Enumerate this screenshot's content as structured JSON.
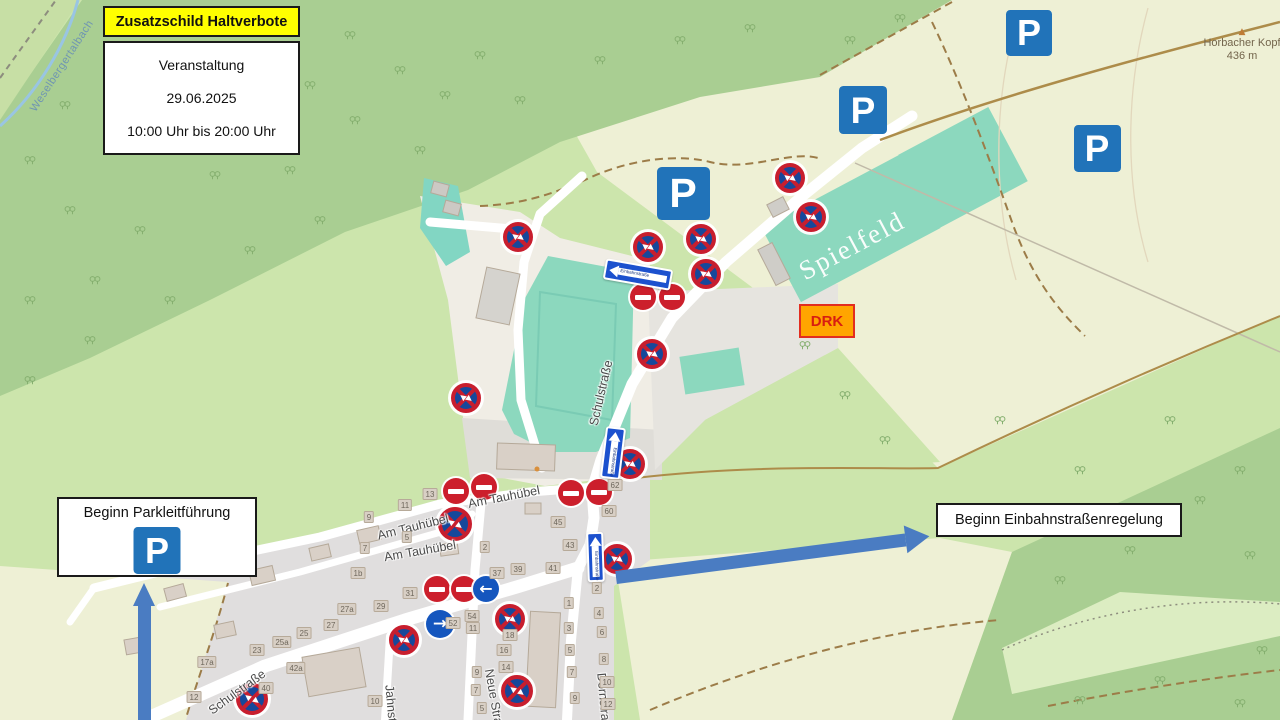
{
  "legend": {
    "title": "Zusatzschild Haltverbote",
    "lines": [
      "Veranstaltung",
      "29.06.2025",
      "10:00 Uhr bis 20:00 Uhr"
    ]
  },
  "callouts": {
    "parkleitfuehrung": "Beginn Parkleitführung",
    "einbahn": "Beginn Einbahnstraßenregelung",
    "drk": "DRK"
  },
  "labels": {
    "spielfeld": "Spielfeld",
    "peak_name": "Horbacher Kopf",
    "peak_elevation": "436 m",
    "peak_icon": "▲",
    "stream": "Weselbergertalbach",
    "streets": [
      {
        "text": "Schulstraße",
        "x": 601,
        "y": 393,
        "rot": -77
      },
      {
        "text": "Schulstraße",
        "x": 237,
        "y": 692,
        "rot": -36
      },
      {
        "text": "Am Tauhübel",
        "x": 504,
        "y": 497,
        "rot": -11
      },
      {
        "text": "Am Tauhübel",
        "x": 413,
        "y": 527,
        "rot": -14
      },
      {
        "text": "Am Tauhübel",
        "x": 420,
        "y": 551,
        "rot": -10
      },
      {
        "text": "Neue Straße",
        "x": 495,
        "y": 704,
        "rot": 80
      },
      {
        "text": "Dornstraße",
        "x": 604,
        "y": 704,
        "rot": 85
      },
      {
        "text": "Jahnstraße",
        "x": 392,
        "y": 716,
        "rot": 85
      }
    ],
    "house_numbers": [
      {
        "t": "13",
        "x": 430,
        "y": 494
      },
      {
        "t": "11",
        "x": 405,
        "y": 505
      },
      {
        "t": "9",
        "x": 369,
        "y": 517
      },
      {
        "t": "5",
        "x": 407,
        "y": 537
      },
      {
        "t": "7",
        "x": 365,
        "y": 548
      },
      {
        "t": "1b",
        "x": 358,
        "y": 573
      },
      {
        "t": "2",
        "x": 485,
        "y": 547
      },
      {
        "t": "45",
        "x": 558,
        "y": 522
      },
      {
        "t": "43",
        "x": 570,
        "y": 545
      },
      {
        "t": "41",
        "x": 553,
        "y": 568
      },
      {
        "t": "39",
        "x": 518,
        "y": 569
      },
      {
        "t": "37",
        "x": 497,
        "y": 573
      },
      {
        "t": "31",
        "x": 410,
        "y": 593
      },
      {
        "t": "29",
        "x": 381,
        "y": 606
      },
      {
        "t": "62",
        "x": 615,
        "y": 485
      },
      {
        "t": "60",
        "x": 609,
        "y": 511
      },
      {
        "t": "27a",
        "x": 347,
        "y": 609
      },
      {
        "t": "27",
        "x": 331,
        "y": 625
      },
      {
        "t": "25",
        "x": 304,
        "y": 633
      },
      {
        "t": "25a",
        "x": 282,
        "y": 642
      },
      {
        "t": "23",
        "x": 257,
        "y": 650
      },
      {
        "t": "42a",
        "x": 296,
        "y": 668
      },
      {
        "t": "17a",
        "x": 207,
        "y": 662
      },
      {
        "t": "12",
        "x": 194,
        "y": 697
      },
      {
        "t": "40",
        "x": 266,
        "y": 688
      },
      {
        "t": "10",
        "x": 375,
        "y": 701
      },
      {
        "t": "54",
        "x": 472,
        "y": 616
      },
      {
        "t": "52",
        "x": 453,
        "y": 623
      },
      {
        "t": "11",
        "x": 473,
        "y": 628
      },
      {
        "t": "18",
        "x": 510,
        "y": 635
      },
      {
        "t": "16",
        "x": 504,
        "y": 650
      },
      {
        "t": "14",
        "x": 506,
        "y": 667
      },
      {
        "t": "9",
        "x": 477,
        "y": 672
      },
      {
        "t": "7",
        "x": 476,
        "y": 690
      },
      {
        "t": "5",
        "x": 482,
        "y": 708
      },
      {
        "t": "1",
        "x": 569,
        "y": 603
      },
      {
        "t": "3",
        "x": 569,
        "y": 628
      },
      {
        "t": "5",
        "x": 570,
        "y": 650
      },
      {
        "t": "7",
        "x": 572,
        "y": 672
      },
      {
        "t": "9",
        "x": 575,
        "y": 698
      },
      {
        "t": "2",
        "x": 597,
        "y": 588
      },
      {
        "t": "4",
        "x": 599,
        "y": 613
      },
      {
        "t": "6",
        "x": 602,
        "y": 632
      },
      {
        "t": "8",
        "x": 604,
        "y": 659
      },
      {
        "t": "10",
        "x": 607,
        "y": 682
      },
      {
        "t": "12",
        "x": 608,
        "y": 704
      }
    ]
  },
  "signs": {
    "parking_letter": "P",
    "one_way_label": "Einbahnstraße",
    "arrow_left_glyph": "←",
    "arrow_right_glyph": "→",
    "parking": [
      {
        "x": 1029,
        "y": 33,
        "s": 46
      },
      {
        "x": 863,
        "y": 110,
        "s": 48
      },
      {
        "x": 1097,
        "y": 148,
        "s": 47
      },
      {
        "x": 683,
        "y": 193,
        "s": 53
      }
    ],
    "no_stopping": [
      {
        "x": 790,
        "y": 178,
        "s": 30
      },
      {
        "x": 811,
        "y": 217,
        "s": 30
      },
      {
        "x": 518,
        "y": 237,
        "s": 30
      },
      {
        "x": 648,
        "y": 247,
        "s": 30
      },
      {
        "x": 701,
        "y": 239,
        "s": 30
      },
      {
        "x": 706,
        "y": 274,
        "s": 30
      },
      {
        "x": 652,
        "y": 354,
        "s": 30
      },
      {
        "x": 466,
        "y": 398,
        "s": 30
      },
      {
        "x": 630,
        "y": 464,
        "s": 30
      },
      {
        "x": 617,
        "y": 559,
        "s": 30
      },
      {
        "x": 455,
        "y": 524,
        "s": 34
      },
      {
        "x": 404,
        "y": 640,
        "s": 30
      },
      {
        "x": 510,
        "y": 619,
        "s": 30
      },
      {
        "x": 517,
        "y": 691,
        "s": 32
      },
      {
        "x": 252,
        "y": 699,
        "s": 32
      }
    ],
    "no_entry": [
      {
        "x": 643,
        "y": 297
      },
      {
        "x": 672,
        "y": 297
      },
      {
        "x": 456,
        "y": 491
      },
      {
        "x": 484,
        "y": 487
      },
      {
        "x": 571,
        "y": 493
      },
      {
        "x": 599,
        "y": 492
      },
      {
        "x": 437,
        "y": 589
      },
      {
        "x": 464,
        "y": 589
      }
    ],
    "mandatory": [
      {
        "x": 486,
        "y": 589,
        "s": 26,
        "dir": "left"
      },
      {
        "x": 440,
        "y": 624,
        "s": 28,
        "dir": "right"
      }
    ],
    "one_way": [
      {
        "x": 638,
        "y": 274,
        "w": 68,
        "h": 21,
        "rot": 10,
        "dir": "left"
      },
      {
        "x": 613,
        "y": 453,
        "w": 20,
        "h": 52,
        "rot": 7,
        "dir": "up"
      },
      {
        "x": 595,
        "y": 557,
        "w": 17,
        "h": 50,
        "rot": -2,
        "dir": "up"
      }
    ]
  },
  "colors": {
    "parking_blue": "#2173B9",
    "oneway_blue": "#1C51CE",
    "sign_red": "#C81E2E",
    "sign_inner_blue": "#16489B",
    "annotation_arrow_blue": "#4A7CC2",
    "highlight_yellow": "#FFFF00",
    "drk_orange": "#FFA500",
    "pitch_teal": "#8CD8BE"
  }
}
